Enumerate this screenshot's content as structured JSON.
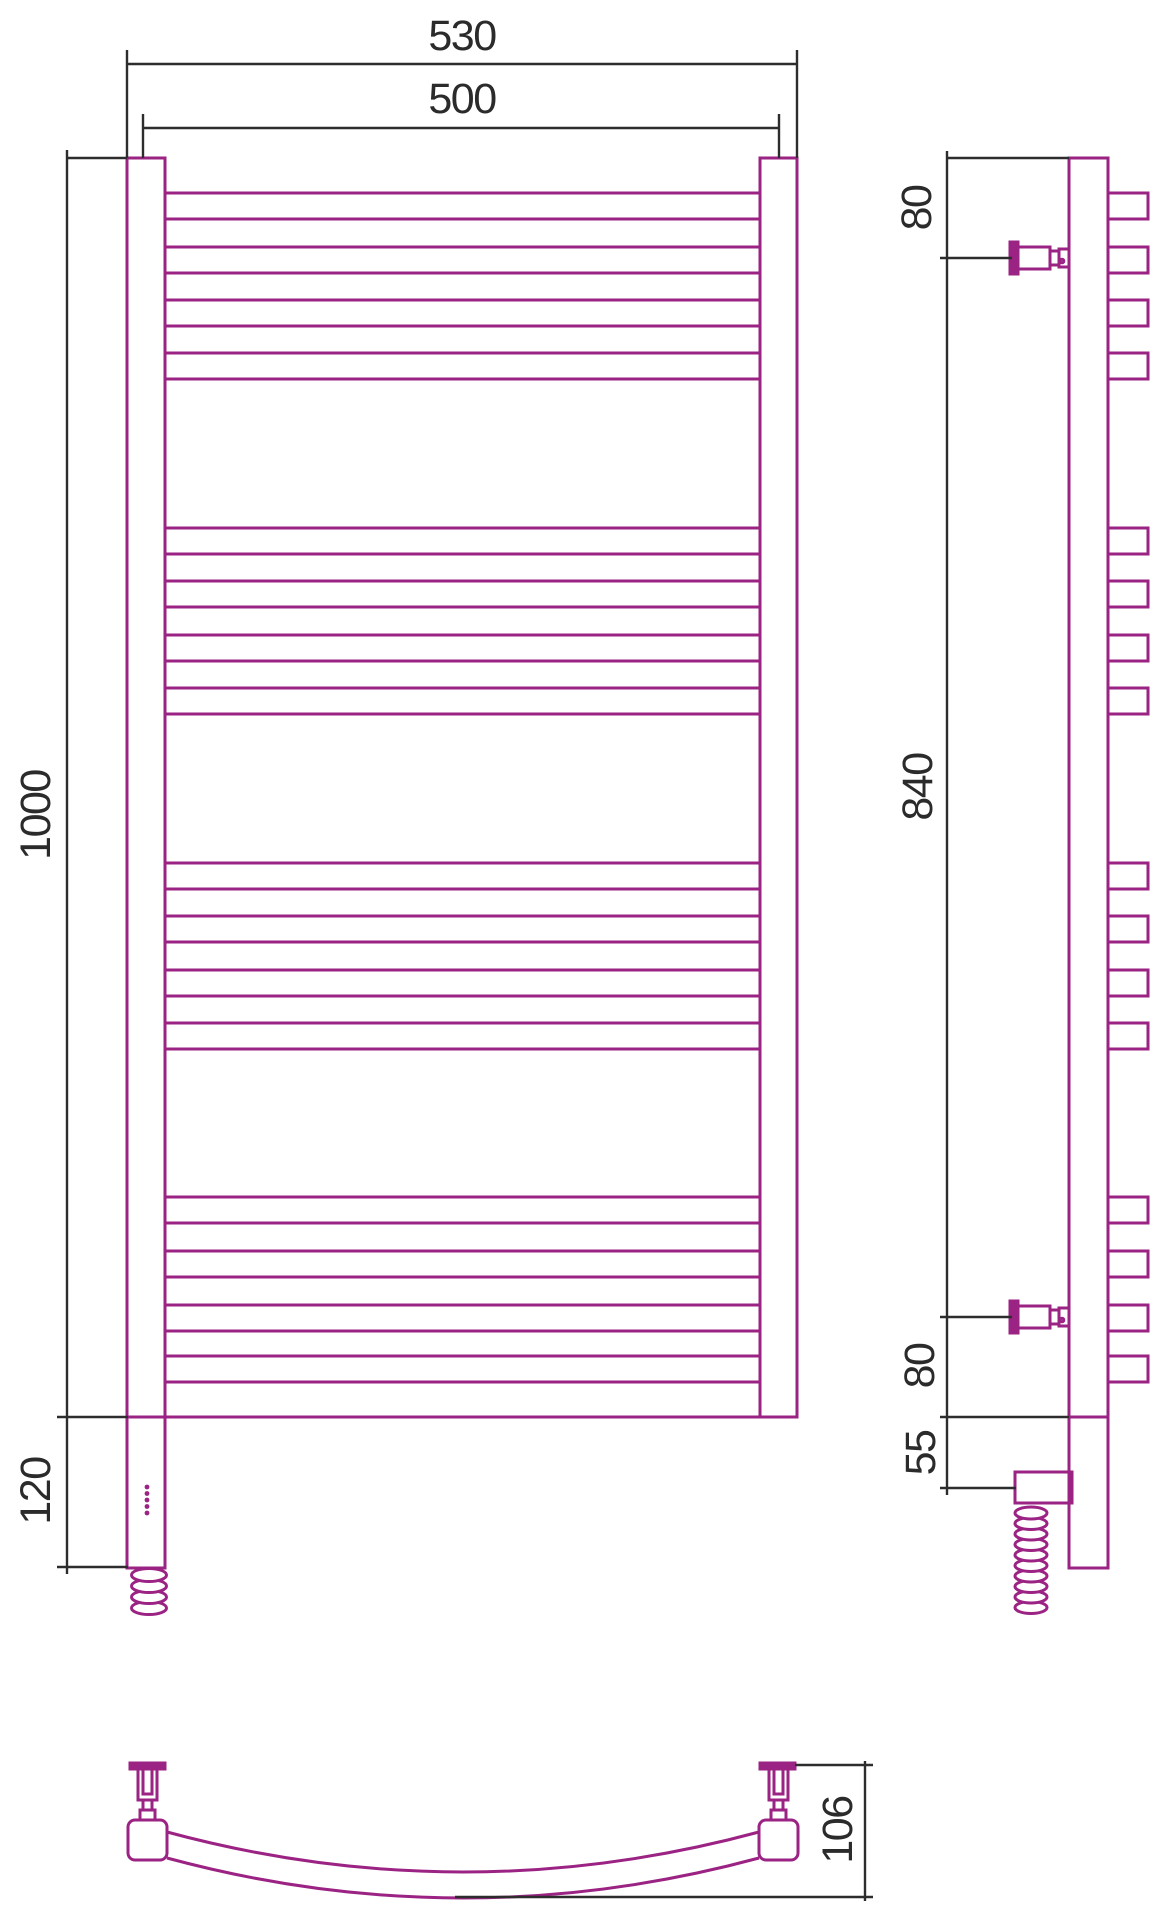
{
  "drawing": {
    "kind": "technical-drawing",
    "subject": "ladder towel rail with electric heating element, three orthographic views",
    "views": [
      "front",
      "side",
      "bottom"
    ]
  },
  "colors": {
    "product_line": "#9B2383",
    "dimension_line": "#2D2D2D",
    "label_text": "#2B2B2B",
    "background": "#FFFFFF"
  },
  "labels": {
    "outer_width": "530",
    "axis_width": "500",
    "rail_height": "1000",
    "heater_section_height": "120",
    "top_bracket_offset": "80",
    "bracket_spacing": "840",
    "bottom_bracket_offset": "80",
    "heater_axis_offset": "55",
    "depth": "106"
  },
  "rungs": {
    "height": 26,
    "front_x": 165,
    "front_width": 595,
    "side_x": 1108,
    "side_width": 40,
    "group_tops": [
      [
        193,
        247,
        300,
        353
      ],
      [
        528,
        581,
        635,
        688
      ],
      [
        863,
        916,
        970,
        1023
      ],
      [
        1197,
        1251,
        1305,
        1356
      ]
    ]
  },
  "indicator_dots": {
    "count": 5,
    "cx": 147,
    "start_cy": 1487,
    "spacing": 6.5,
    "radius": 2.4
  },
  "coils": {
    "front": {
      "cx": 149,
      "start_cy": 1575,
      "loops": 4,
      "rx": 17.5,
      "ry": 6.5,
      "pitch": 11
    },
    "side": {
      "cx": 1031,
      "start_cy": 1513,
      "loops": 10,
      "rx": 16,
      "ry": 6,
      "pitch": 10.5
    }
  },
  "side_brackets": {
    "centers": [
      258,
      1317
    ]
  }
}
